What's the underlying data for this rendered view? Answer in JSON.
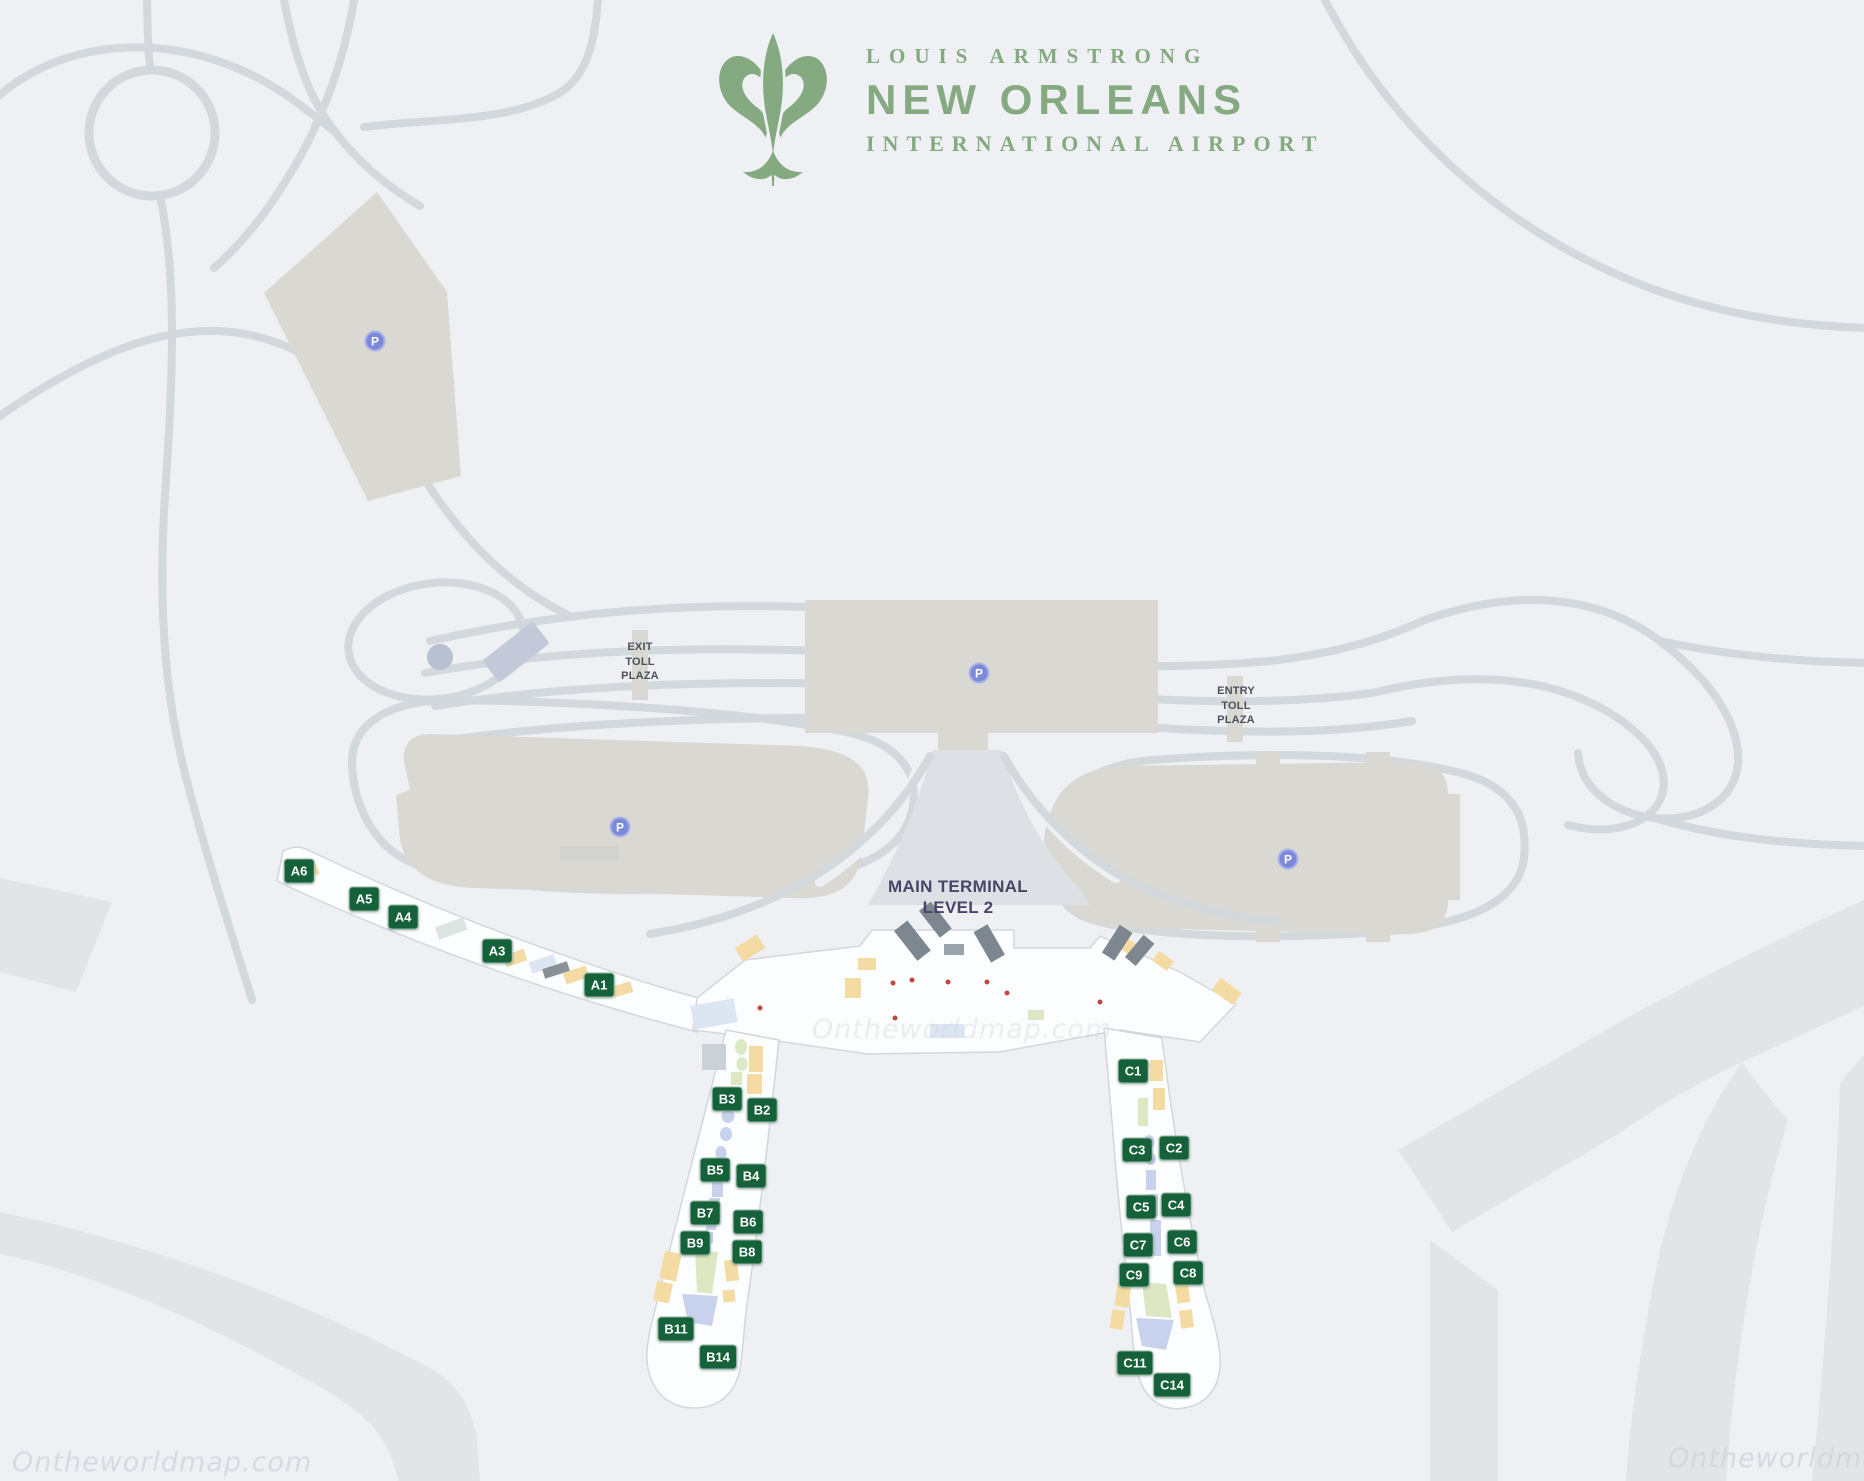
{
  "logo": {
    "line1": "LOUIS ARMSTRONG",
    "line2": "NEW ORLEANS",
    "line3": "INTERNATIONAL AIRPORT",
    "brand_green": "#85a981"
  },
  "labels": {
    "exit_toll": {
      "lines": [
        "EXIT",
        "TOLL",
        "PLAZA"
      ]
    },
    "entry_toll": {
      "lines": [
        "ENTRY",
        "TOLL",
        "PLAZA"
      ]
    },
    "main_terminal": {
      "lines": [
        "MAIN TERMINAL",
        "LEVEL 2"
      ]
    }
  },
  "colors": {
    "background": "#eef0f3",
    "road": "#d3d8dc",
    "parking_fill": "#d9d8d3",
    "gate_badge": "#15613a",
    "parking_badge": "#7c88d9"
  },
  "parking": {
    "symbol": "P",
    "positions": [
      {
        "x": 375,
        "y": 341
      },
      {
        "x": 979,
        "y": 673
      },
      {
        "x": 620,
        "y": 827
      },
      {
        "x": 1288,
        "y": 859
      }
    ]
  },
  "gates": {
    "items": [
      {
        "label": "A6",
        "x": 299,
        "y": 871
      },
      {
        "label": "A5",
        "x": 364,
        "y": 899
      },
      {
        "label": "A4",
        "x": 403,
        "y": 917
      },
      {
        "label": "A3",
        "x": 497,
        "y": 951
      },
      {
        "label": "A1",
        "x": 599,
        "y": 985
      },
      {
        "label": "B3",
        "x": 727,
        "y": 1099
      },
      {
        "label": "B2",
        "x": 762,
        "y": 1110
      },
      {
        "label": "B5",
        "x": 715,
        "y": 1170
      },
      {
        "label": "B4",
        "x": 751,
        "y": 1176
      },
      {
        "label": "B7",
        "x": 705,
        "y": 1213
      },
      {
        "label": "B6",
        "x": 748,
        "y": 1222
      },
      {
        "label": "B9",
        "x": 695,
        "y": 1243
      },
      {
        "label": "B8",
        "x": 747,
        "y": 1252
      },
      {
        "label": "B11",
        "x": 676,
        "y": 1329
      },
      {
        "label": "B14",
        "x": 718,
        "y": 1357
      },
      {
        "label": "C1",
        "x": 1133,
        "y": 1071
      },
      {
        "label": "C3",
        "x": 1137,
        "y": 1150
      },
      {
        "label": "C2",
        "x": 1174,
        "y": 1148
      },
      {
        "label": "C5",
        "x": 1141,
        "y": 1207
      },
      {
        "label": "C4",
        "x": 1176,
        "y": 1205
      },
      {
        "label": "C7",
        "x": 1138,
        "y": 1245
      },
      {
        "label": "C6",
        "x": 1182,
        "y": 1242
      },
      {
        "label": "C9",
        "x": 1134,
        "y": 1275
      },
      {
        "label": "C8",
        "x": 1188,
        "y": 1273
      },
      {
        "label": "C11",
        "x": 1135,
        "y": 1363
      },
      {
        "label": "C14",
        "x": 1172,
        "y": 1385
      }
    ]
  },
  "watermarks": [
    {
      "text": "Ontheworldmap.com",
      "x": 12,
      "y": 1447,
      "opacity": 0.8,
      "center": false
    },
    {
      "text": "Ontheworldmap.com",
      "x": 962,
      "y": 1014,
      "opacity": 0.38,
      "center": true
    },
    {
      "text": "Ontheworldmap.com",
      "x": 1668,
      "y": 1443,
      "opacity": 0.85,
      "center": false
    }
  ]
}
